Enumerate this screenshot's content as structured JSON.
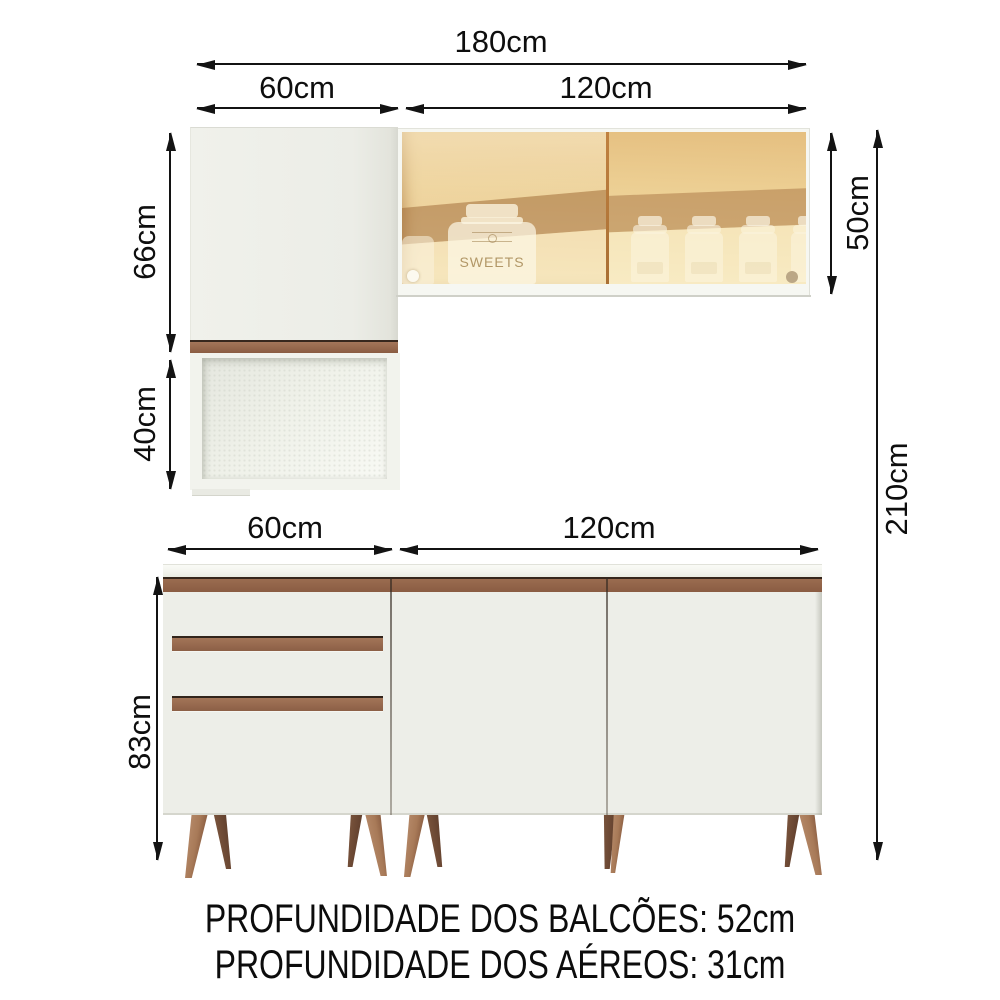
{
  "diagram": {
    "dimension_labels": {
      "total_width": "180cm",
      "upper_left_width": "60cm",
      "upper_right_width": "120cm",
      "upper_door_height": "66cm",
      "niche_height": "40cm",
      "upper_right_height": "50cm",
      "total_height": "210cm",
      "base_left_width": "60cm",
      "base_right_width": "120cm",
      "base_height": "83cm"
    },
    "notes": {
      "counter_depth": "PROFUNDIDADE DOS BALCÕES: 52cm",
      "wall_cabinet_depth": "PROFUNDIDADE DOS AÉREOS: 31cm"
    },
    "decor": {
      "jar_label": "SWEETS"
    },
    "colors": {
      "background": "#ffffff",
      "cabinet_body": "#edeee8",
      "handle_brown": "#9a6c50",
      "counter_brown": "#8e6148",
      "glass_amber": "#ecd096",
      "glass_shadow_brown": "#a26f3f",
      "leg_wood": "#a87a58",
      "leg_wood_dark": "#6e4833",
      "dimension_line": "#131313"
    }
  }
}
